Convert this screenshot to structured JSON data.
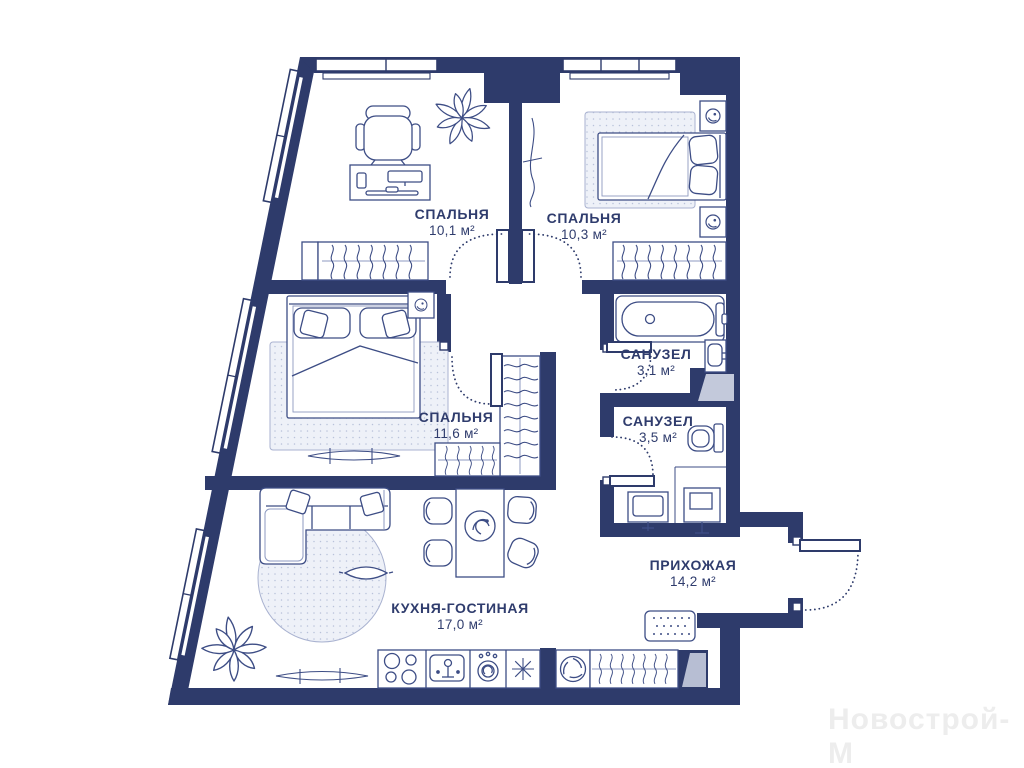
{
  "plan": {
    "rooms": [
      {
        "id": "bedroom-1",
        "name": "СПАЛЬНЯ",
        "area": "10,1 м²"
      },
      {
        "id": "bedroom-2",
        "name": "СПАЛЬНЯ",
        "area": "10,3 м²"
      },
      {
        "id": "bedroom-3",
        "name": "СПАЛЬНЯ",
        "area": "11,6 м²"
      },
      {
        "id": "bathroom-1",
        "name": "САНУЗЕЛ",
        "area": "3,1 м²"
      },
      {
        "id": "bathroom-2",
        "name": "САНУЗЕЛ",
        "area": "3,5 м²"
      },
      {
        "id": "hallway",
        "name": "ПРИХОЖАЯ",
        "area": "14,2 м²"
      },
      {
        "id": "kitchen-living",
        "name": "КУХНЯ-ГОСТИНАЯ",
        "area": "17,0 м²"
      }
    ],
    "watermark": "Новострой-М",
    "colors": {
      "wall": "#2e3b6b",
      "furniture_line": "#3d4d85",
      "rug_fill": "#eef1f8",
      "shaft_gray": "#c3c9db",
      "watermark": "#ededed",
      "background": "#ffffff",
      "label_text": "#2f3c6d"
    }
  }
}
